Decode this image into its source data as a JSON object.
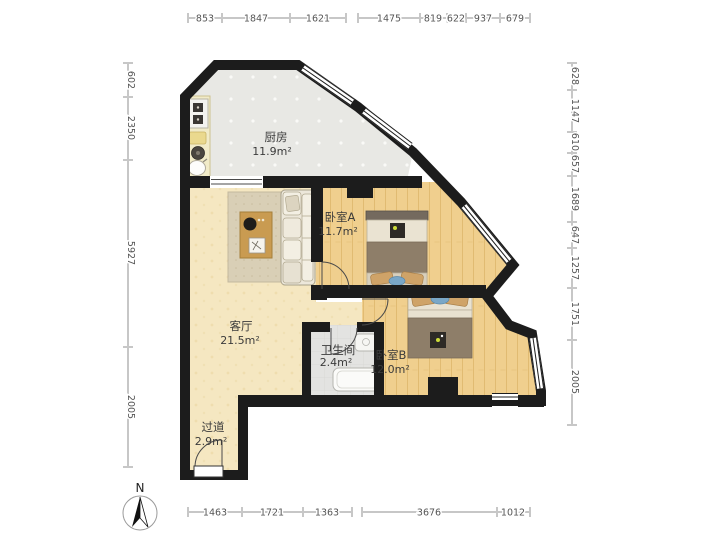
{
  "compass": {
    "north_label": "N"
  },
  "rooms": [
    {
      "id": "kitchen",
      "name": "厨房",
      "area": "11.9m²"
    },
    {
      "id": "living",
      "name": "客厅",
      "area": "21.5m²"
    },
    {
      "id": "bedroomA",
      "name": "卧室A",
      "area": "11.7m²"
    },
    {
      "id": "bedroomB",
      "name": "卧室B",
      "area": "12.0m²"
    },
    {
      "id": "bathroom",
      "name": "卫生间",
      "area": "2.4m²"
    },
    {
      "id": "hallway",
      "name": "过道",
      "area": "2.9m²"
    }
  ],
  "dims": {
    "top": [
      "853",
      "1847",
      "1621",
      "1475",
      "819",
      "622",
      "937",
      "679"
    ],
    "left": [
      "602",
      "2350",
      "5927",
      "2005"
    ],
    "right": [
      "628",
      "1147",
      "610",
      "657",
      "1689",
      "647",
      "1257",
      "1751",
      "2005"
    ],
    "bottom": [
      "1463",
      "1721",
      "1363",
      "3676",
      "1012"
    ]
  },
  "colors": {
    "wall": "#1c1c1c",
    "floor_wood": "#f0cf8e",
    "floor_living": "#f5e7c1",
    "floor_tile": "#e8e8e4",
    "rug": "#d9cfb6",
    "accent_blue": "#7aa7c7",
    "dim_text": "#555555"
  }
}
